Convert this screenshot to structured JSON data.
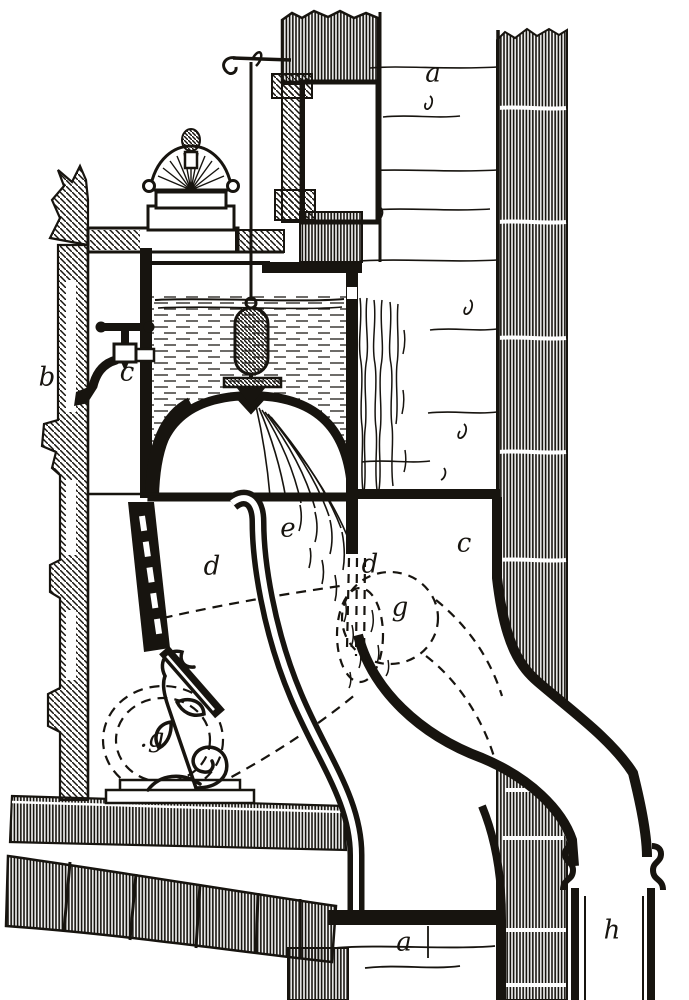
{
  "figure": {
    "kind": "engraved-sectional-diagram",
    "ink_color": "#17140f",
    "paper_color": "#ffffff",
    "labels": [
      {
        "id": "a-upper-masonry",
        "char": "a",
        "x": 433,
        "y": 75
      },
      {
        "id": "b-left-wall",
        "char": "b",
        "x": 47,
        "y": 379
      },
      {
        "id": "c-tap",
        "char": "c",
        "x": 127,
        "y": 374
      },
      {
        "id": "e-chamber",
        "char": "e",
        "x": 288,
        "y": 530
      },
      {
        "id": "d-left-channel",
        "char": "d",
        "x": 212,
        "y": 568
      },
      {
        "id": "d-center-channel",
        "char": "d",
        "x": 370,
        "y": 566
      },
      {
        "id": "c-right-channel",
        "char": "c",
        "x": 464,
        "y": 545
      },
      {
        "id": "g-right-drum",
        "char": "g",
        "x": 400,
        "y": 609
      },
      {
        "id": "g-left-drum",
        "char": ".g",
        "x": 152,
        "y": 740
      },
      {
        "id": "a-lower-masonry",
        "char": "a",
        "x": 404,
        "y": 944
      },
      {
        "id": "h-outlet-pipe",
        "char": "h",
        "x": 612,
        "y": 932
      }
    ]
  }
}
